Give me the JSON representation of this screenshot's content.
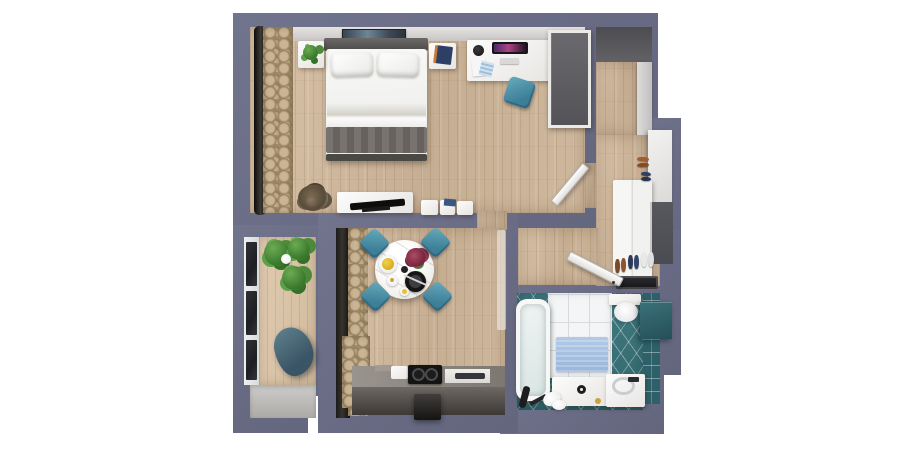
{
  "scene": {
    "description": "3D top-down render of a one-bedroom apartment floor plan on a white background",
    "view": "bird's-eye / dollhouse",
    "background_color": "#ffffff"
  },
  "palette": {
    "wall": "#696c86",
    "wood_floor": "#cdb69a",
    "balcony_wood": "#d9c4a8",
    "bathroom_floor_tile": "#3b7077",
    "bathroom_wall_tile": "#2d6068",
    "accent_teal_seating": "#4e93ac",
    "curtain_tan": "#a98f6b",
    "kitchen_counter": "#55504c",
    "bed_linen": "#f6f6f5",
    "throw_blanket_gray": "#6e6a67",
    "bath_mat_blue": "#a7c1e4",
    "monitor_screen": "#ab4586"
  },
  "rooms": [
    {
      "id": "bedroom",
      "name": "bedroom",
      "furniture": [
        "double-bed",
        "pillows",
        "gray-throw-blanket",
        "headboard",
        "nightstand-left",
        "nightstand-plant",
        "nightstand-right",
        "book",
        "wall-picture",
        "curtains",
        "desk",
        "monitor",
        "keyboard",
        "papers",
        "person",
        "desk-chair",
        "wardrobe",
        "interior-door-open",
        "tv-bench",
        "tv",
        "storage-boxes",
        "floor-plant"
      ]
    },
    {
      "id": "entry-hall",
      "name": "entry hall",
      "furniture": [
        "dark-niche",
        "shoe-cabinet",
        "tall-cabinet",
        "white-wardrobe",
        "front-door",
        "shoes-pairs",
        "door-mat"
      ]
    },
    {
      "id": "corridor",
      "name": "corridor",
      "furniture": [
        "open-door"
      ]
    },
    {
      "id": "living-kitchen",
      "name": "living-dining room with kitchenette",
      "furniture": [
        "window-glazing",
        "curtains",
        "curtain-bunch",
        "round-dining-table",
        "lemon-plate",
        "flower-bouquet",
        "black-plate",
        "cutlery",
        "teapot",
        "cup",
        "dining-chair-nw",
        "dining-chair-ne",
        "dining-chair-sw",
        "dining-chair-se",
        "kitchen-counter",
        "cutting-boards",
        "cooktop",
        "sink",
        "range-hood"
      ]
    },
    {
      "id": "balcony",
      "name": "balcony",
      "furniture": [
        "glazing-panels",
        "potted-plants",
        "lounge-chair",
        "concrete-slab"
      ]
    },
    {
      "id": "bathroom",
      "name": "bathroom",
      "furniture": [
        "bathtub",
        "white-wall-tiles",
        "blue-bath-mat",
        "wall-hung-toilet",
        "teal-wall-cabinet",
        "vanity-sink",
        "faucet",
        "washing-machine",
        "shower-accessories",
        "towels"
      ]
    }
  ]
}
